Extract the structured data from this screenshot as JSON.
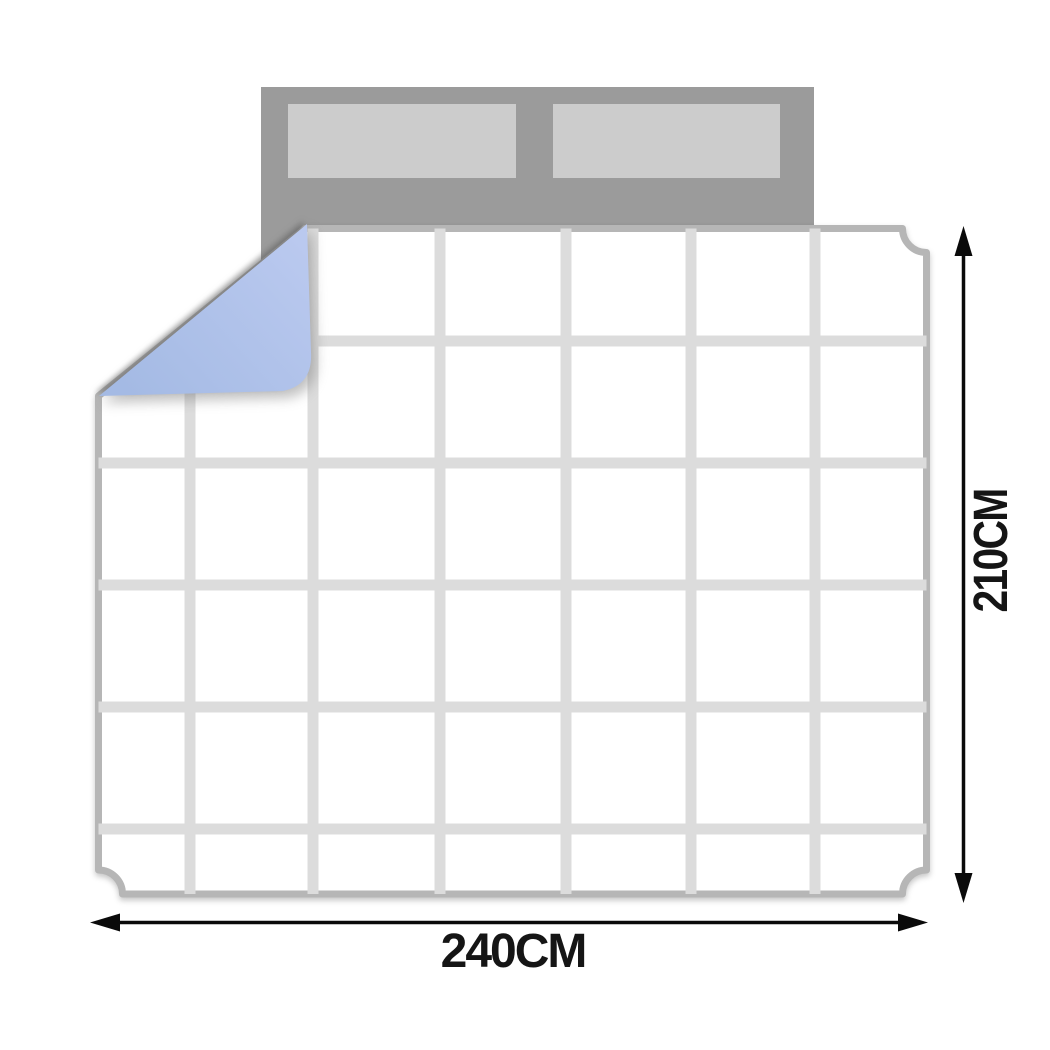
{
  "diagram_type": "bedding-size-diagram",
  "dimensions": {
    "width_label": "240CM",
    "height_label": "210CM"
  },
  "bed": {
    "headboard_color": "#9b9b9b",
    "pillow_color": "#cccccc",
    "pillow_count": 2
  },
  "quilt": {
    "fill_color": "#ffffff",
    "border_color": "#b6b6b6",
    "grid_line_color": "#dcdcdc",
    "grid_columns": 7,
    "grid_rows": 6,
    "fold_corner_color": "#aabfe8",
    "fold_position": "top-left"
  },
  "arrows": {
    "color": "#0a0a0a"
  }
}
